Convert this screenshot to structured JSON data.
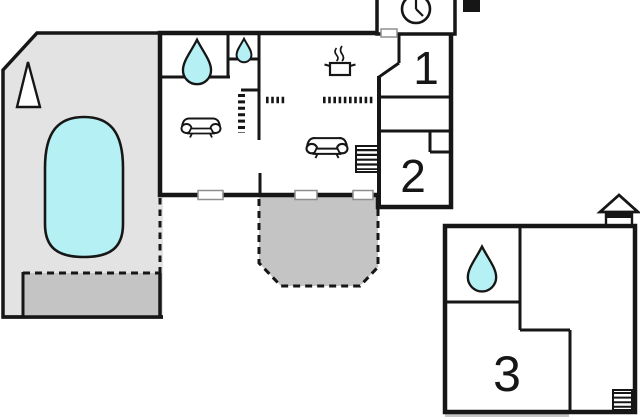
{
  "floorplan": {
    "type": "vacation-home-floor-plan",
    "rooms": [
      {
        "id": "room-1",
        "label": "1"
      },
      {
        "id": "room-2",
        "label": "2"
      },
      {
        "id": "room-3",
        "label": "3"
      }
    ],
    "icons": [
      "pool",
      "tree",
      "water-drop-large",
      "water-drop-small",
      "water-drop-annex",
      "sofa-1",
      "sofa-2",
      "cooking-pot",
      "clock",
      "chimney",
      "stairs-main",
      "stairs-wing",
      "ladder-annex",
      "house-annex",
      "door-markers"
    ],
    "colors": {
      "pool": "#b5f1f4",
      "pool_house_floor": "#e3e3e3",
      "terrace": "#c4c4c4",
      "wall": "#161616",
      "door_marker_border": "#8f8f8f"
    }
  }
}
